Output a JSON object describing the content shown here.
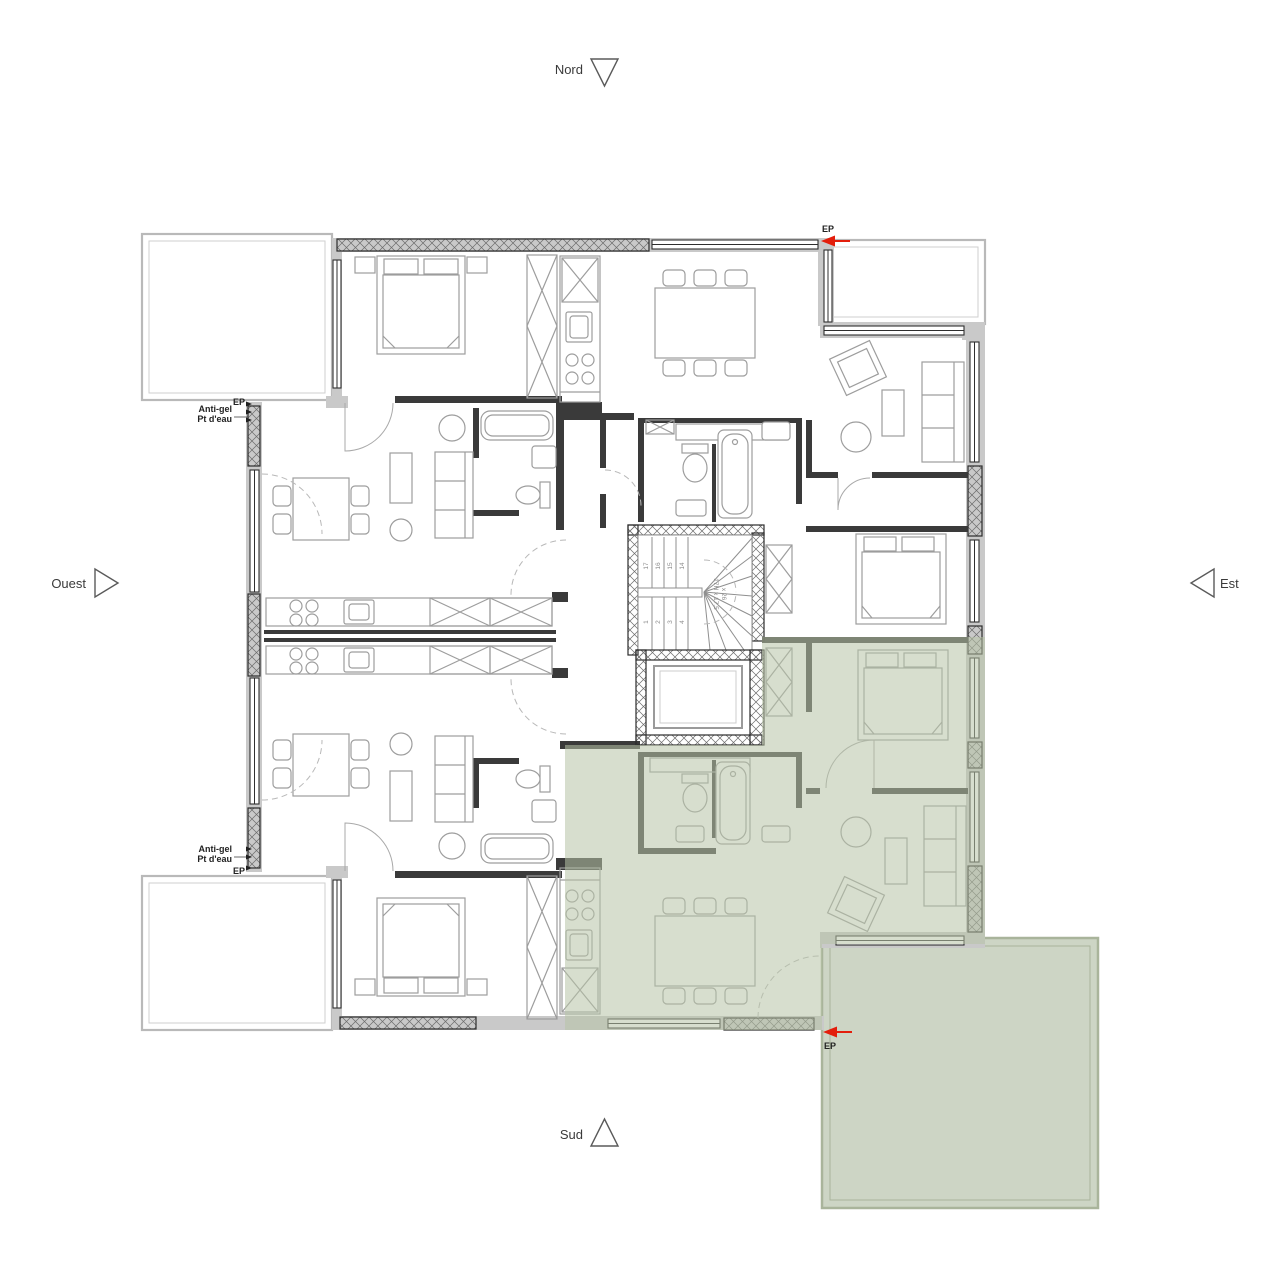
{
  "compass": {
    "north": "Nord",
    "south": "Sud",
    "east": "Est",
    "west": "Ouest"
  },
  "annotations": {
    "ep": "EP",
    "antigel": "Anti-gel",
    "pt_eau": "Pt d'eau"
  },
  "stairs": {
    "lower": [
      "1",
      "2",
      "3",
      "4"
    ],
    "upper": [
      "17",
      "16",
      "15",
      "14"
    ],
    "dim_line1": "17H x 17.5",
    "dim_line2": "x 26"
  },
  "colors": {
    "highlight_green": "#ccd4c2",
    "terrace_border": "#a9b49b",
    "wall_gray": "#c9c9c9",
    "wall_dark": "#3a3a3a",
    "furniture_gray": "#9d9d9d",
    "ep_red": "#e31e0c"
  }
}
